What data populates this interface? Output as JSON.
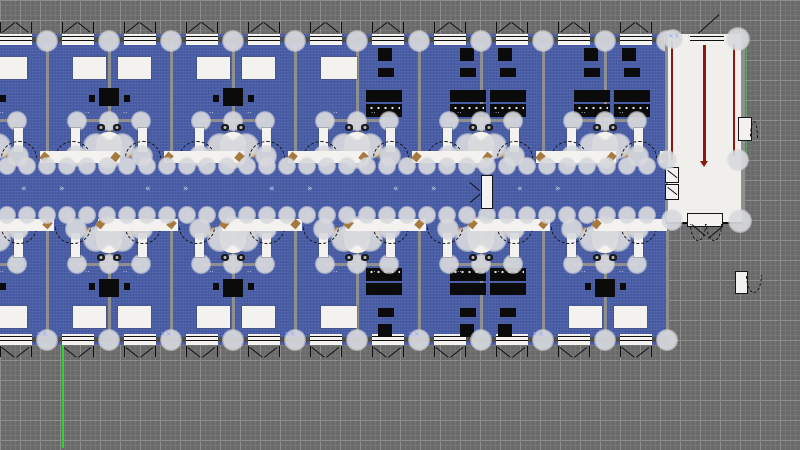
{
  "app": {
    "name": "floor-plan-cad-viewport"
  },
  "canvas": {
    "width": 800,
    "height": 450,
    "grid": {
      "bg": "#6a6a6a",
      "minor": "#757575",
      "major": "#8d8d8d",
      "minor_step": 5,
      "major_step": 20
    }
  },
  "colors": {
    "floor": "#4a5ea7",
    "wallgray": "#8f8f8f",
    "white": "#f3f2ef",
    "black": "#0b0b0b",
    "tan": "#a5793f",
    "wing": "#f0efec",
    "red": "#8e170d",
    "axis": "#2fd32f",
    "node": "#d8d9dd",
    "bluemark": "#8fa6ff",
    "wing_green_edge": "#58b868"
  },
  "layout": {
    "unit_width": 124,
    "half_unit": 62,
    "unit_boundaries": [
      -77,
      47,
      171,
      295,
      419,
      543
    ],
    "plan_right": 667,
    "mirror_const": 385,
    "floor_rect": {
      "x": -80,
      "y": 34,
      "w": 748,
      "h": 311
    },
    "top_wall": {
      "y": 34,
      "h": 11
    },
    "bottom_wall": {
      "y": 334,
      "h": 11
    },
    "bands": {
      "top_y": 45,
      "top_h": 106,
      "bottom_y": 231,
      "bottom_h": 103
    },
    "corridor": {
      "top_bar_y": 151,
      "bottom_bar_y": 219,
      "bar_h": 12,
      "node_rows_y": [
        166,
        215
      ],
      "node_step": 20
    },
    "window": {
      "offset": 15,
      "width": 32
    },
    "vline_count": 13
  },
  "units": {
    "top_types": [
      "A",
      "A",
      "A",
      "AB",
      "B",
      "B"
    ],
    "bottom_types": [
      "A",
      "A",
      "A",
      "AB",
      "B",
      "A"
    ]
  },
  "furniture_templates": {
    "A": [
      [
        "bed",
        26,
        57,
        33,
        22
      ],
      [
        "bed",
        71,
        57,
        33,
        22
      ],
      [
        "table",
        52,
        88,
        20,
        18
      ],
      [
        "chair",
        42,
        95,
        6,
        7
      ],
      [
        "chair",
        77,
        95,
        6,
        7
      ]
    ],
    "B": [
      [
        "black",
        41,
        48,
        14,
        13
      ],
      [
        "black",
        79,
        48,
        14,
        13
      ],
      [
        "black",
        41,
        68,
        16,
        9
      ],
      [
        "black",
        81,
        68,
        16,
        9
      ],
      [
        "black",
        31,
        90,
        36,
        12
      ],
      [
        "black",
        71,
        90,
        36,
        12
      ],
      [
        "desk",
        31,
        104,
        36,
        13
      ],
      [
        "desk",
        71,
        104,
        36,
        13
      ]
    ],
    "AB": [
      [
        "bed",
        26,
        57,
        36,
        22
      ],
      [
        "black",
        83,
        48,
        14,
        13
      ],
      [
        "black",
        83,
        68,
        16,
        9
      ],
      [
        "black",
        71,
        90,
        36,
        12
      ],
      [
        "desk",
        71,
        104,
        36,
        13
      ]
    ]
  },
  "bathroom": {
    "white_rects": [
      [
        -38,
        128,
        9,
        24
      ],
      [
        29,
        128,
        9,
        24
      ]
    ],
    "sinks": [
      [
        -12,
        124,
        8,
        7
      ],
      [
        4,
        124,
        8,
        7
      ]
    ],
    "toilet": [
      -13,
      132,
      26,
      26
    ],
    "leaves": [
      [
        -24,
        150,
        7,
        7
      ],
      [
        17,
        150,
        7,
        7
      ]
    ],
    "nodes": [
      [
        -13,
        146,
        13
      ],
      [
        13,
        146,
        13
      ],
      [
        0,
        154,
        15
      ],
      [
        -33,
        156,
        11
      ],
      [
        33,
        156,
        11
      ]
    ]
  },
  "midrow": {
    "line": [
      -32,
      119,
      64,
      3
    ],
    "nodes": [
      [
        -32,
        121,
        10
      ],
      [
        0,
        121,
        10
      ],
      [
        32,
        121,
        10
      ]
    ],
    "glyph_dx": [
      -24,
      14
    ],
    "glyph_y": 110
  },
  "door_arcs": {
    "dx": [
      8,
      78
    ],
    "top_y": 141,
    "h": 17,
    "w": 36
  },
  "corridor_detail": {
    "top_gap_dx": 11,
    "bottom_gap_dx": -55,
    "gap_w": 44,
    "tan_top_dx": [
      3,
      56
    ],
    "tan_bottom_dx": [
      -65,
      -12
    ],
    "mid_door": {
      "x": 482,
      "y": 176,
      "w": 10,
      "h": 32
    },
    "arrow_pairs_b": [
      47,
      171,
      295,
      419,
      543
    ],
    "arrow_left_dx": -26,
    "arrow_right_dx": 12,
    "arrow_y": 185
  },
  "wing": {
    "floor": [
      667,
      34,
      75,
      188
    ],
    "left_wall": [
      665,
      34,
      3,
      189
    ],
    "right_wall": [
      741,
      34,
      4,
      189
    ],
    "red_lines": [
      [
        671,
        42,
        2,
        118
      ],
      [
        703,
        40,
        3,
        121
      ],
      [
        733,
        44,
        2,
        112
      ]
    ],
    "red_arrow_tip": [
      700,
      161
    ],
    "top_window": [
      690,
      34,
      34,
      11
    ],
    "green_edge": [
      746,
      34,
      1,
      126
    ],
    "bottom_white": [
      667,
      214,
      75,
      9
    ],
    "bottom_line": [
      666,
      222,
      77,
      2
    ],
    "bottom_door": [
      688,
      214,
      34,
      12
    ],
    "bottom_arcs_x": [
      690,
      706
    ],
    "left_doors": [
      [
        666,
        168,
        12,
        14
      ],
      [
        666,
        185,
        12,
        14
      ]
    ],
    "tabs": [
      [
        739,
        118,
        12,
        22
      ],
      [
        736,
        272,
        11,
        21
      ]
    ],
    "corner_nodes": [
      [
        673,
        39,
        10
      ],
      [
        738,
        39,
        12
      ],
      [
        667,
        160,
        10
      ],
      [
        738,
        160,
        11
      ],
      [
        672,
        220,
        11
      ],
      [
        740,
        221,
        12
      ]
    ]
  },
  "axis_line": {
    "x": 62,
    "y1": 345,
    "y2": 448,
    "w": 2
  },
  "glyphs": {
    "unit_marks": "··",
    "arrow_left": "«",
    "arrow_right": "»",
    "cross": "××"
  }
}
